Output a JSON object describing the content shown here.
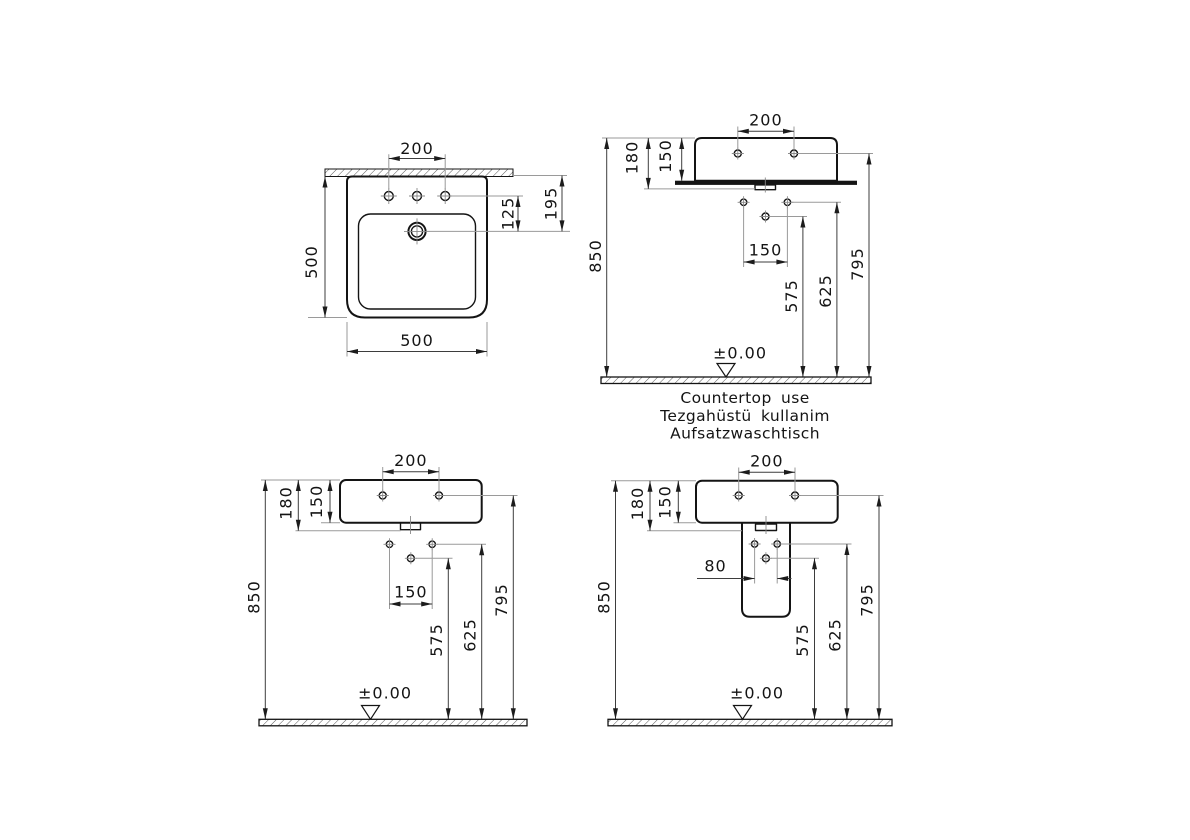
{
  "drawing": {
    "type": "washbasin technical dimension drawing",
    "colors": {
      "line": "#141414",
      "dim": "#3d3d3d",
      "extension": "#9a9a9a",
      "background": "#ffffff"
    }
  },
  "views": {
    "plan": {
      "tap_spacing": "200",
      "depth": "500",
      "width": "500",
      "faucet_offset": "125",
      "faucet_from_rear": "195"
    },
    "countertop": {
      "tap_spacing": "200",
      "height_total": "180",
      "height_basin": "150",
      "height_rim": "850",
      "hole_spacing": "150",
      "height_lower_hole": "575",
      "height_holes": "625",
      "height_taps": "795",
      "datum": "±0.00",
      "captions": [
        "Countertop use",
        "Tezgahüstü kullanim",
        "Aufsatzwaschtisch"
      ]
    },
    "wall_hung": {
      "tap_spacing": "200",
      "height_total": "180",
      "height_basin": "150",
      "height_rim": "850",
      "hole_spacing": "150",
      "height_lower_hole": "575",
      "height_holes": "625",
      "height_taps": "795",
      "datum": "±0.00"
    },
    "half_pedestal": {
      "tap_spacing": "200",
      "height_total": "180",
      "height_basin": "150",
      "height_rim": "850",
      "hole_spacing": "80",
      "height_lower_hole": "575",
      "height_holes": "625",
      "height_taps": "795",
      "datum": "±0.00"
    }
  }
}
